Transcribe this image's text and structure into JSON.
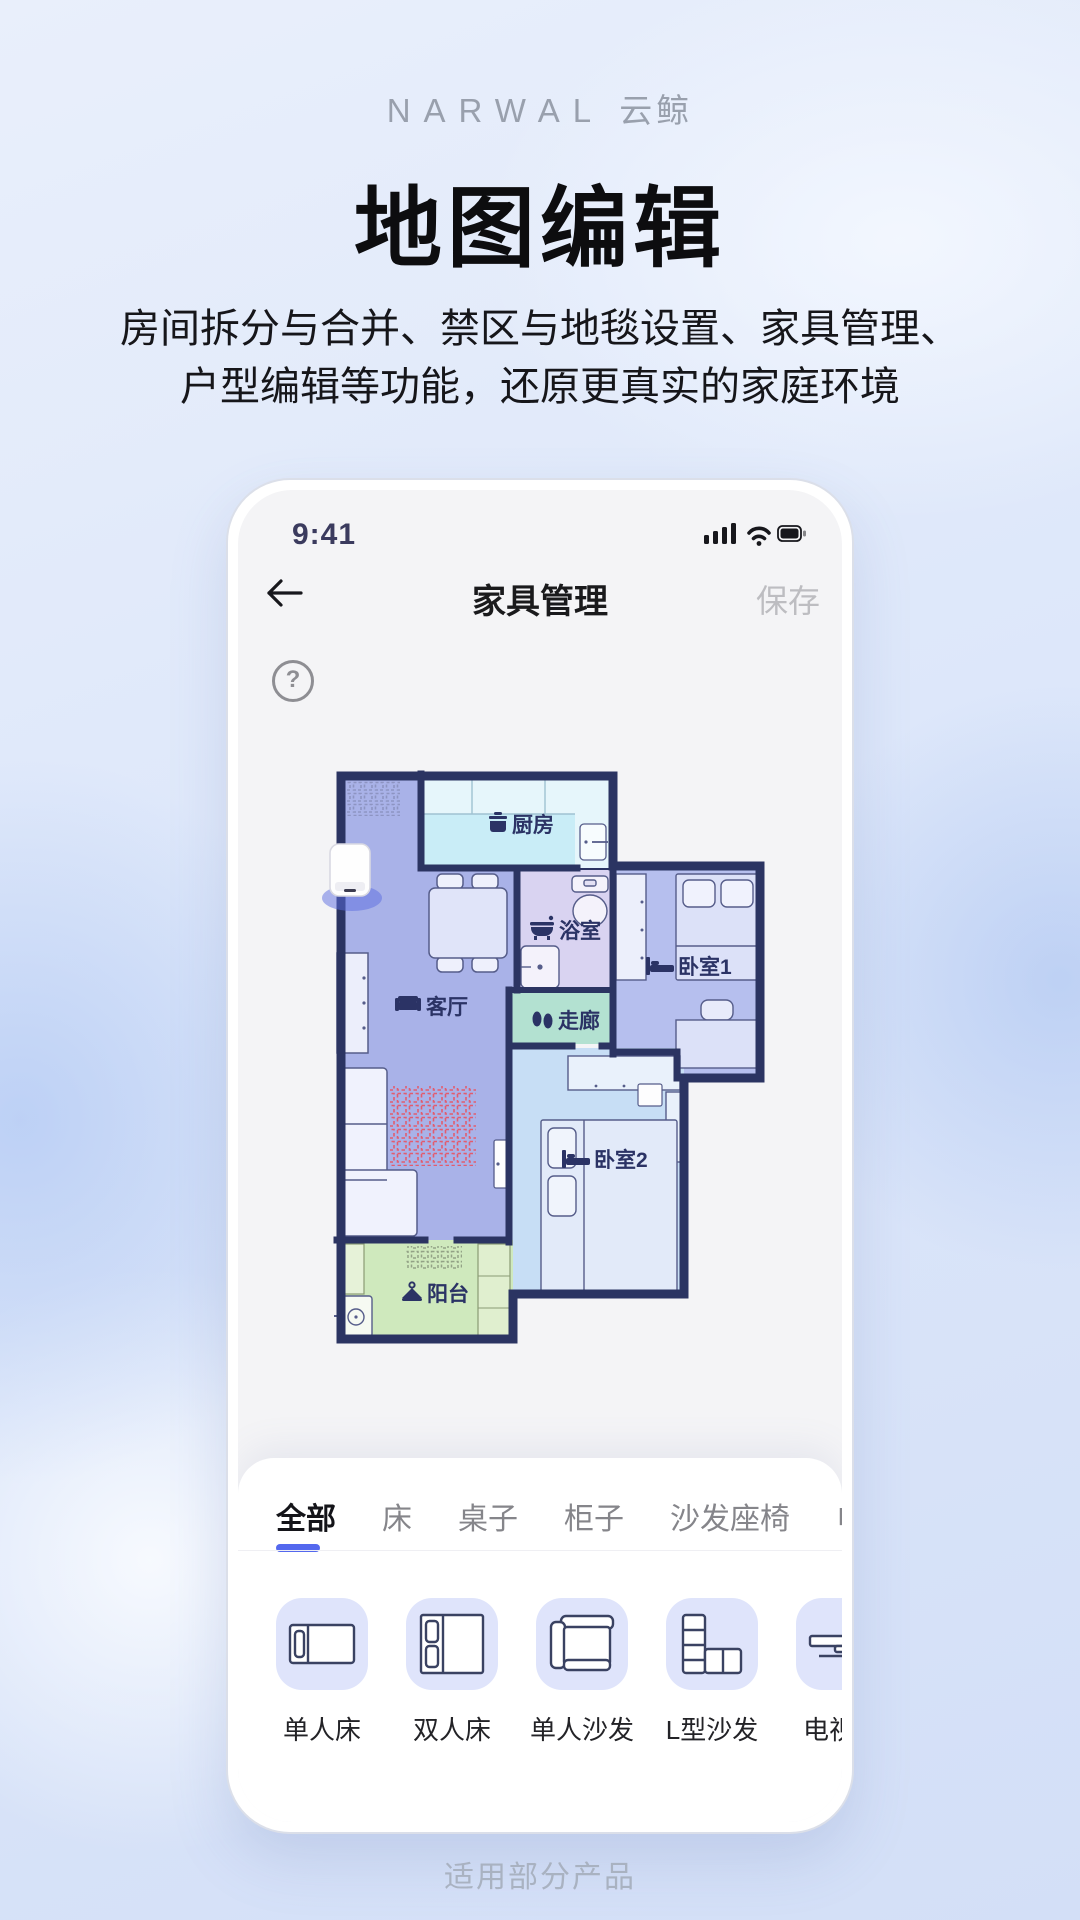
{
  "page": {
    "logo_brand": "NARWAL",
    "logo_cn": "云鲸",
    "title": "地图编辑",
    "subtitle_line1": "房间拆分与合并、禁区与地毯设置、家具管理、",
    "subtitle_line2": "户型编辑等功能，还原更真实的家庭环境",
    "footer_note": "适用部分产品"
  },
  "phone": {
    "status_bar": {
      "time": "9:41"
    },
    "nav": {
      "title": "家具管理",
      "save_label": "保存",
      "help_glyph": "?"
    },
    "map": {
      "rooms": [
        {
          "id": "kitchen",
          "label": "厨房"
        },
        {
          "id": "bathroom",
          "label": "浴室"
        },
        {
          "id": "bedroom1",
          "label": "卧室1"
        },
        {
          "id": "living-room",
          "label": "客厅"
        },
        {
          "id": "corridor",
          "label": "走廊"
        },
        {
          "id": "bedroom2",
          "label": "卧室2"
        },
        {
          "id": "balcony",
          "label": "阳台"
        }
      ]
    },
    "sheet": {
      "tabs": [
        {
          "label": "全部",
          "active": true
        },
        {
          "label": "床",
          "active": false
        },
        {
          "label": "桌子",
          "active": false
        },
        {
          "label": "柜子",
          "active": false
        },
        {
          "label": "沙发座椅",
          "active": false
        },
        {
          "label": "电视柜",
          "active": false
        }
      ],
      "items": [
        {
          "label": "单人床",
          "icon": "single-bed-icon"
        },
        {
          "label": "双人床",
          "icon": "double-bed-icon"
        },
        {
          "label": "单人沙发",
          "icon": "single-sofa-icon"
        },
        {
          "label": "L型沙发",
          "icon": "l-sofa-icon"
        },
        {
          "label": "电视柜",
          "icon": "tv-stand-icon"
        }
      ]
    }
  },
  "colors": {
    "accent_blue": "#5468ee",
    "wall_navy": "#2b3462",
    "living_room_fill": "#a9b2e8",
    "kitchen_fill": "#c9edf7",
    "bathroom_fill": "#d9d3f1",
    "corridor_fill": "#b3e1d1",
    "bedroom1_fill": "#b6bfee",
    "bedroom2_fill": "#c7def5",
    "balcony_fill": "#cfe9bd",
    "no_mop_zone_red": "#e25c6e"
  }
}
